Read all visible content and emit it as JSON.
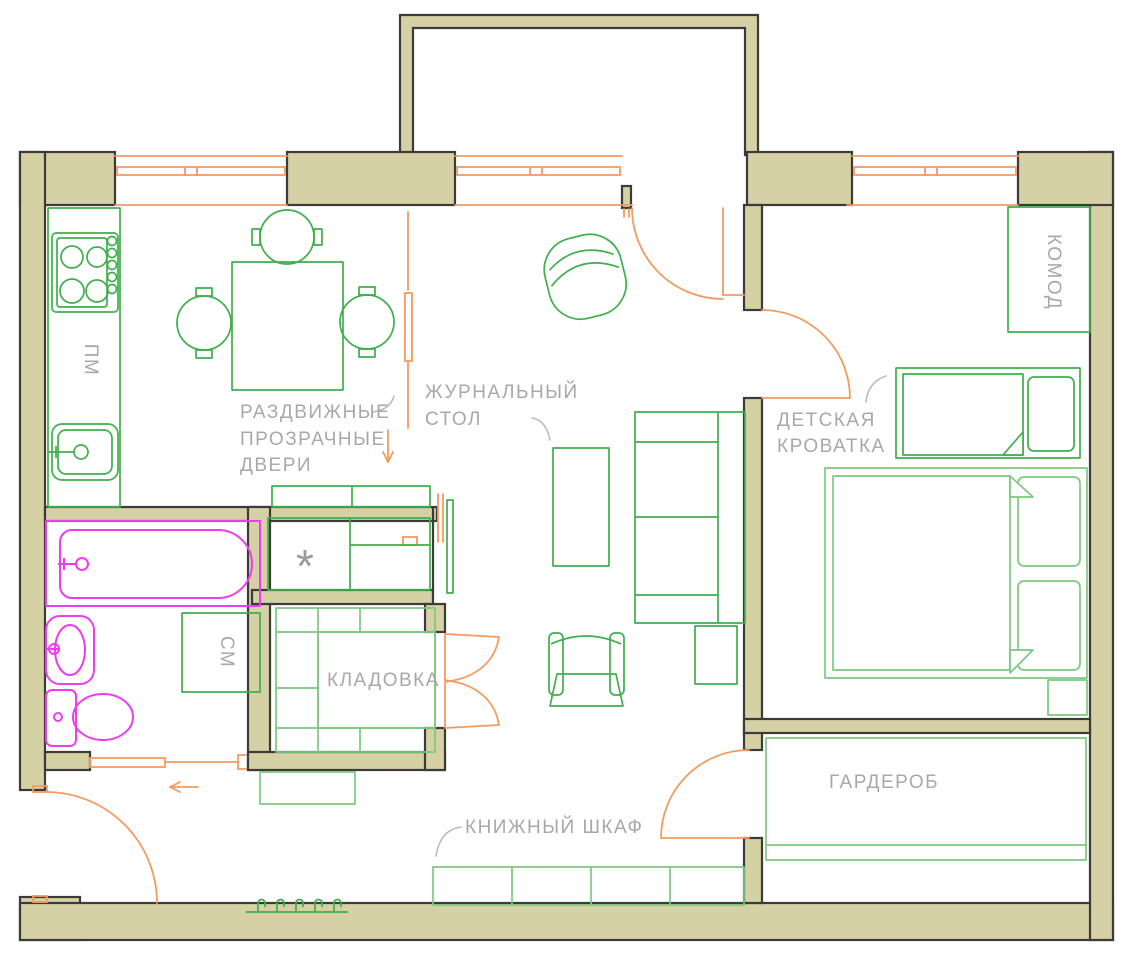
{
  "floor_plan": {
    "labels": {
      "dishwasher": "ПМ",
      "sliding_doors_1": "РАЗДВИЖНЫЕ",
      "sliding_doors_2": "ПРОЗРАЧНЫЕ",
      "sliding_doors_3": "ДВЕРИ",
      "coffee_table_1": "ЖУРНАЛЬНЫЙ",
      "coffee_table_2": "СТОЛ",
      "dresser": "КОМОД",
      "kids_bed_1": "ДЕТСКАЯ",
      "kids_bed_2": "КРОВАТКА",
      "washer": "СМ",
      "pantry": "КЛАДОВКА",
      "bookcase": "КНИЖНЫЙ ШКАФ",
      "wardrobe": "ГАРДЕРОБ",
      "snowflake": "*"
    },
    "colors": {
      "wall_fill": "#d6d0a5",
      "wall_outline": "#3b3b39",
      "furniture_green": "#3fae4c",
      "furniture_green_light": "#7cc87f",
      "doors_windows_orange": "#f49a62",
      "sanitary_magenta": "#ee3cf0",
      "label_gray": "#a8a8a8"
    }
  }
}
